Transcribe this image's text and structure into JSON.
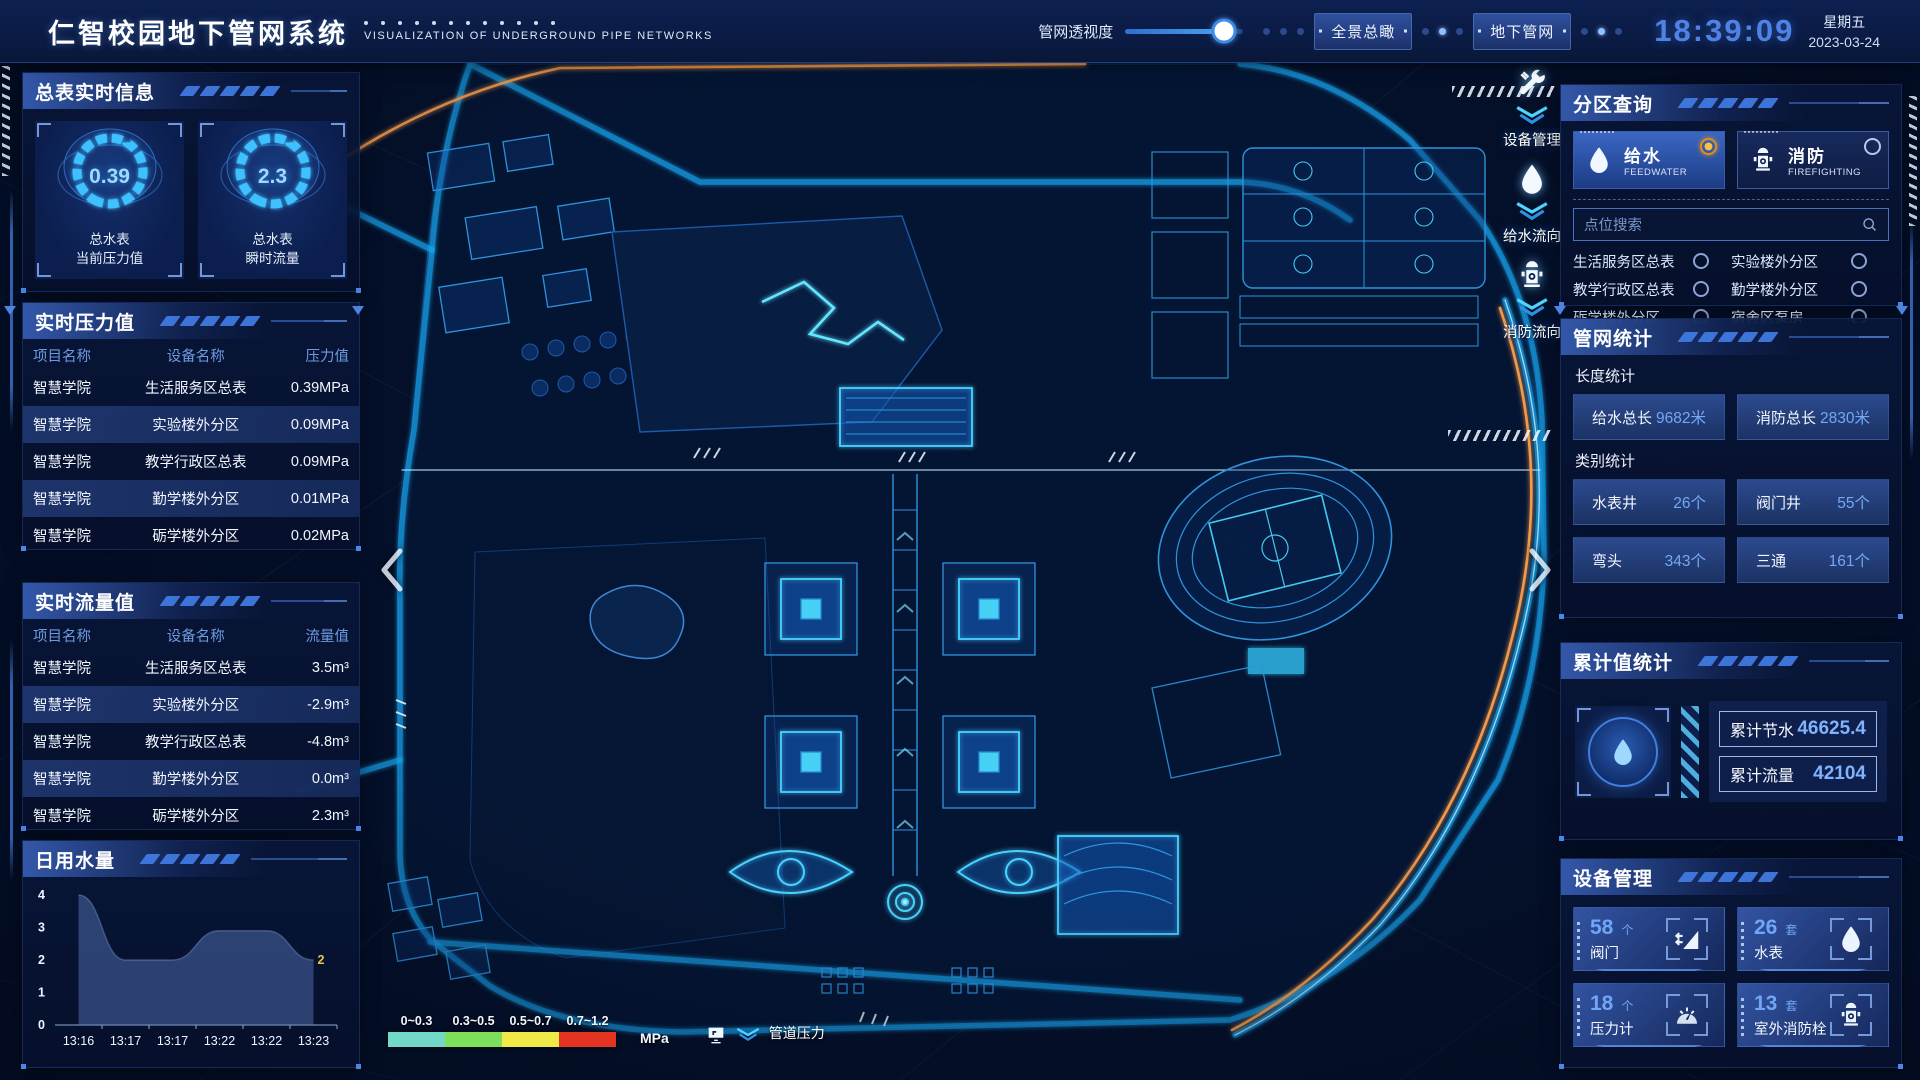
{
  "header": {
    "title": "仁智校园地下管网系统",
    "subtitle": "VISUALIZATION OF UNDERGROUND PIPE NETWORKS",
    "slider_label": "管网透视度",
    "slider_percent": 84,
    "buttons": [
      {
        "label": "全景总瞰"
      },
      {
        "label": "地下管网"
      }
    ],
    "clock": {
      "time": "18:39:09",
      "weekday": "星期五",
      "date": "2023-03-24"
    }
  },
  "left": {
    "master_info": {
      "title": "总表实时信息",
      "gauges": [
        {
          "value": "0.39",
          "label_line1": "总水表",
          "label_line2": "当前压力值"
        },
        {
          "value": "2.3",
          "label_line1": "总水表",
          "label_line2": "瞬时流量"
        }
      ]
    },
    "pressure": {
      "title": "实时压力值",
      "headers": [
        "项目名称",
        "设备名称",
        "压力值"
      ],
      "rows": [
        [
          "智慧学院",
          "生活服务区总表",
          "0.39MPa"
        ],
        [
          "智慧学院",
          "实验楼外分区",
          "0.09MPa"
        ],
        [
          "智慧学院",
          "教学行政区总表",
          "0.09MPa"
        ],
        [
          "智慧学院",
          "勤学楼外分区",
          "0.01MPa"
        ],
        [
          "智慧学院",
          "砺学楼外分区",
          "0.02MPa"
        ]
      ]
    },
    "flow": {
      "title": "实时流量值",
      "headers": [
        "项目名称",
        "设备名称",
        "流量值"
      ],
      "rows": [
        [
          "智慧学院",
          "生活服务区总表",
          "3.5m³"
        ],
        [
          "智慧学院",
          "实验楼外分区",
          "-2.9m³"
        ],
        [
          "智慧学院",
          "教学行政区总表",
          "-4.8m³"
        ],
        [
          "智慧学院",
          "勤学楼外分区",
          "0.0m³"
        ],
        [
          "智慧学院",
          "砺学楼外分区",
          "2.3m³"
        ]
      ]
    },
    "daily_water": {
      "title": "日用水量"
    }
  },
  "chart_data": {
    "type": "area",
    "title": "日用水量",
    "x": [
      "13:16",
      "13:17",
      "13:17",
      "13:22",
      "13:22",
      "13:23"
    ],
    "values": [
      4,
      2,
      2,
      2.9,
      2.9,
      2
    ],
    "ylim": [
      0,
      4
    ],
    "yticks": [
      0,
      1,
      2,
      3,
      4
    ],
    "last_point_label": "2",
    "fill_color": "#5a7cc0",
    "legend_position": "none",
    "grid": false
  },
  "right": {
    "zone_query": {
      "title": "分区查询",
      "tabs": [
        {
          "label": "给水",
          "sub": "FEEDWATER",
          "icon": "water-drop-icon",
          "selected": true
        },
        {
          "label": "消防",
          "sub": "FIREFIGHTING",
          "icon": "hydrant-icon",
          "selected": false
        }
      ],
      "search_placeholder": "点位搜索",
      "options": [
        "生活服务区总表",
        "实验楼外分区",
        "教学行政区总表",
        "勤学楼外分区",
        "砺学楼外分区",
        "宿舍区泵房"
      ]
    },
    "pipe_stats": {
      "title": "管网统计",
      "length_title": "长度统计",
      "length_items": [
        {
          "label": "给水总长",
          "value": "9682米"
        },
        {
          "label": "消防总长",
          "value": "2830米"
        }
      ],
      "category_title": "类别统计",
      "category_items": [
        {
          "label": "水表井",
          "value": "26个"
        },
        {
          "label": "阀门井",
          "value": "55个"
        },
        {
          "label": "弯头",
          "value": "343个"
        },
        {
          "label": "三通",
          "value": "161个"
        }
      ]
    },
    "cumulative": {
      "title": "累计值统计",
      "items": [
        {
          "label": "累计节水",
          "value": "46625.4"
        },
        {
          "label": "累计流量",
          "value": "42104"
        }
      ]
    },
    "devices": {
      "title": "设备管理",
      "cards": [
        {
          "count": "58",
          "unit": "个",
          "label": "阀门",
          "icon": "valve-icon"
        },
        {
          "count": "26",
          "unit": "套",
          "label": "水表",
          "icon": "water-drop-icon"
        },
        {
          "count": "18",
          "unit": "个",
          "label": "压力计",
          "icon": "pressure-gauge-icon"
        },
        {
          "count": "13",
          "unit": "套",
          "label": "室外消防栓",
          "icon": "hydrant-icon"
        }
      ]
    }
  },
  "map": {
    "controls": [
      {
        "label": "设备管理",
        "icon": "tools-icon"
      },
      {
        "label": "给水流向",
        "icon": "water-drop-icon"
      },
      {
        "label": "消防流向",
        "icon": "hydrant-icon"
      }
    ],
    "legend": {
      "ranges": [
        {
          "label": "0~0.3",
          "color": "#72d8c8"
        },
        {
          "label": "0.3~0.5",
          "color": "#7de05a"
        },
        {
          "label": "0.5~0.7",
          "color": "#f0ea48"
        },
        {
          "label": "0.7~1.2",
          "color": "#e23420"
        }
      ],
      "unit": "MPa",
      "caption": "管道压力"
    }
  }
}
